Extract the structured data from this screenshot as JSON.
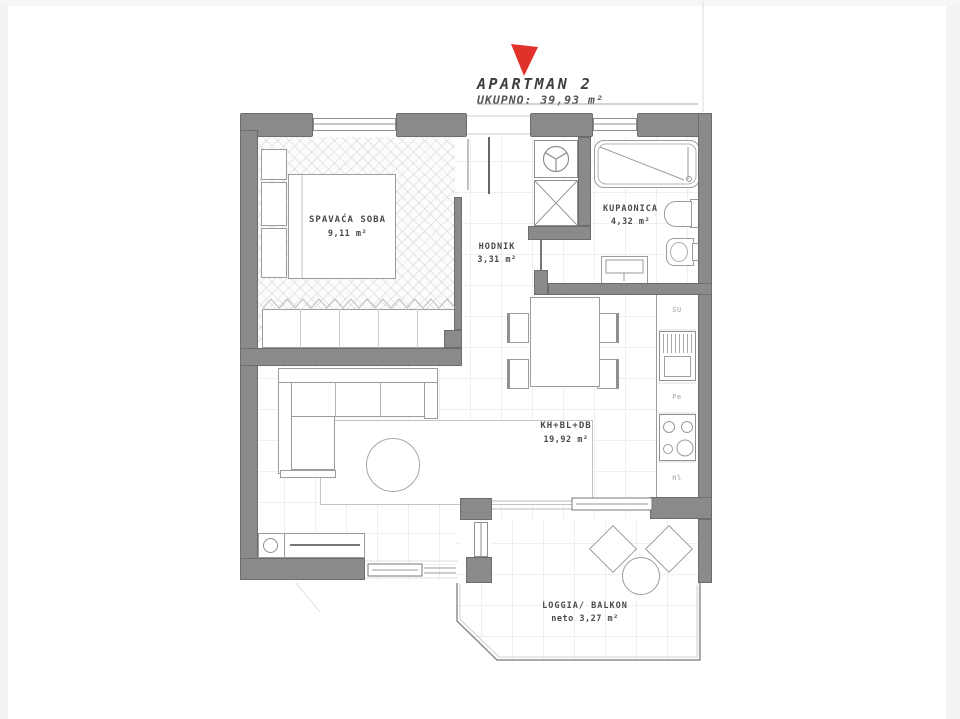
{
  "title": {
    "name": "APARTMAN 2",
    "total": "UKUPNO: 39,93 m²"
  },
  "rooms": [
    {
      "id": "bedroom",
      "label": "SPAVAĆA SOBA",
      "area": "9,11 m²"
    },
    {
      "id": "hallway",
      "label": "HODNIK",
      "area": "3,31 m²"
    },
    {
      "id": "bathroom",
      "label": "KUPAONICA",
      "area": "4,32 m²"
    },
    {
      "id": "living",
      "label": "KH+BL+DB",
      "area": "19,92 m²"
    },
    {
      "id": "loggia",
      "label": "LOGGIA/ BALKON",
      "area": "neto 3,27 m²"
    }
  ],
  "kitchen": {
    "sink_label": "SU",
    "oven_label": "Pe",
    "fridge_label": "Hl"
  },
  "icons": [
    "entrance-arrow-icon",
    "ventilation-fan-icon",
    "shaft-cross-icon"
  ],
  "colors": {
    "wall": "#8a8a8a",
    "wall_border": "#6d6d6d",
    "fixture_line": "#9c9c9c",
    "text": "#4a4a4a",
    "accent_red": "#e0312a",
    "grid": "#efefef"
  }
}
